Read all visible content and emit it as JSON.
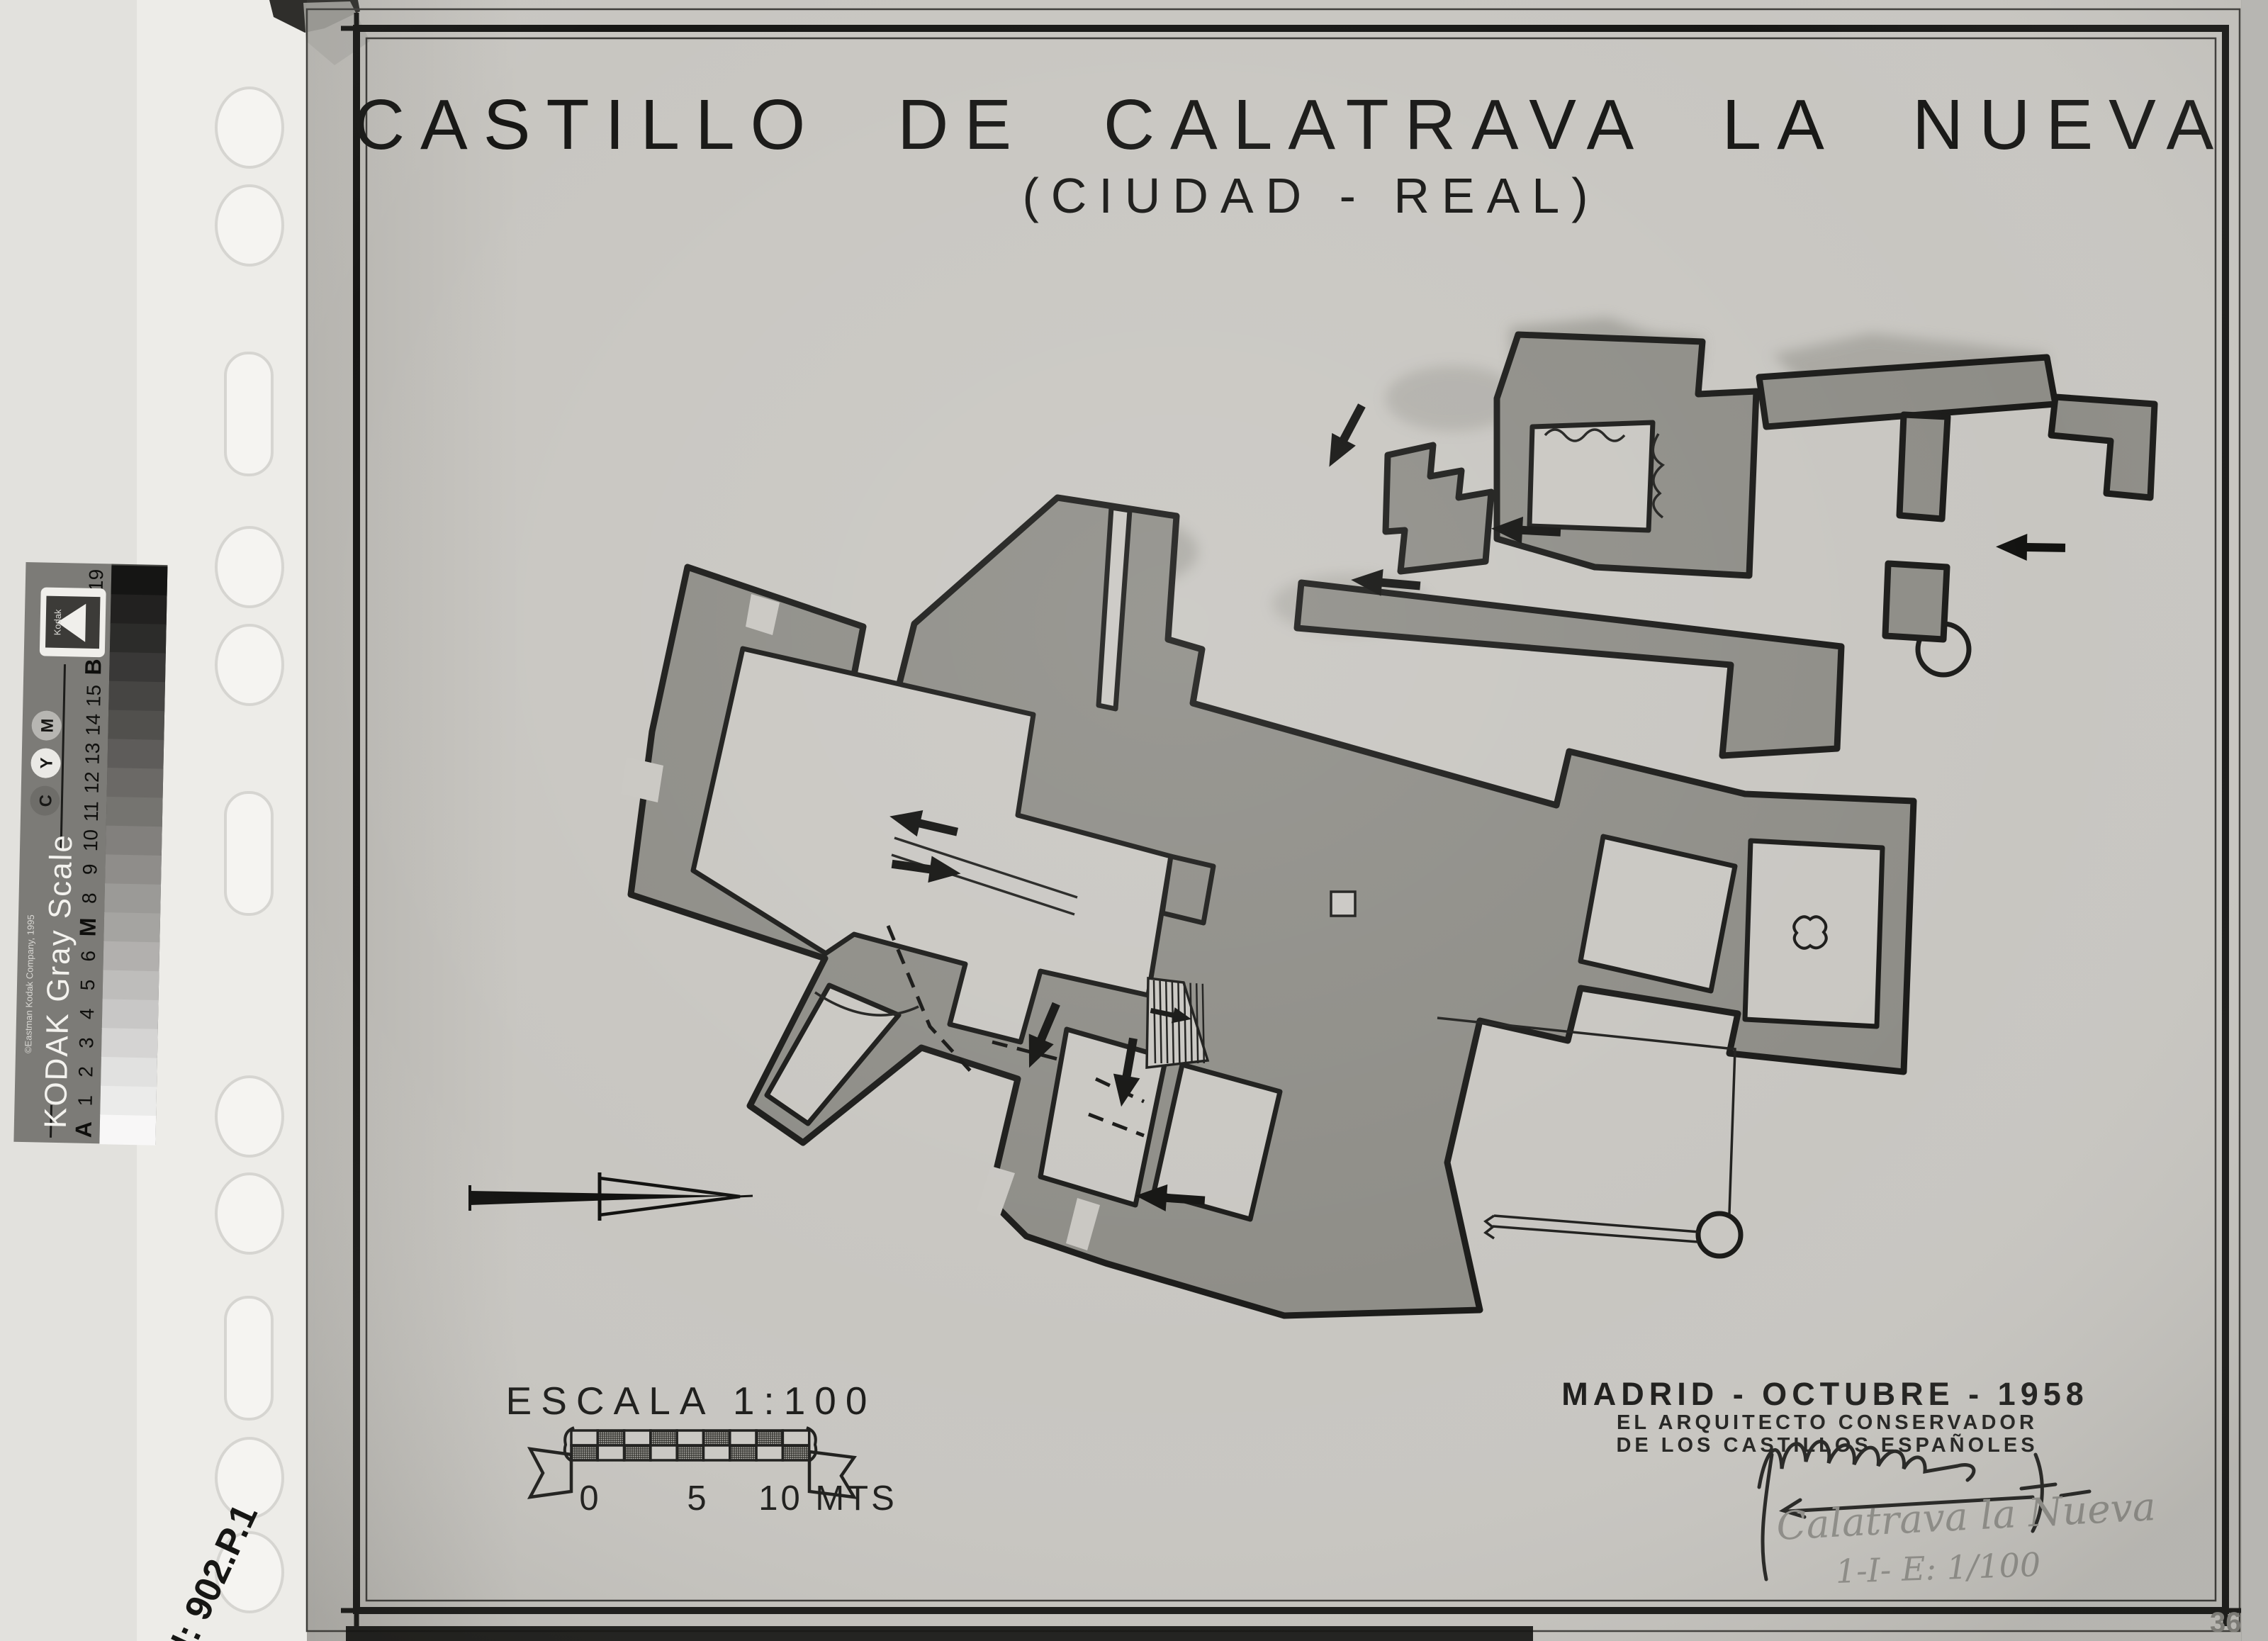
{
  "plan": {
    "title": "CASTILLO DE CALATRAVA LA NUEVA",
    "subtitle": "(CIUDAD - REAL)",
    "sheet_number": "36",
    "scale": {
      "label": "ESCALA 1:100",
      "tick0": "0",
      "tick5": "5",
      "tick10": "10 MTS"
    },
    "credits": {
      "line1": "MADRID - OCTUBRE - 1958",
      "line2": "EL ARQUITECTO CONSERVADOR",
      "line3": "DE LOS CASTILLOS ESPAÑOLES",
      "note_title": "Calatrava la Nueva",
      "note_ref": "1-I- E: 1/100"
    }
  },
  "annotations": {
    "archive_number": "N: 902.P.1"
  },
  "gray_scale": {
    "brand": "KODAK Gray Scale",
    "copyright": "©Eastman Kodak Company, 1995",
    "logo": "Kodak",
    "labels": [
      "19",
      "18",
      "17",
      "B",
      "15",
      "14",
      "13",
      "12",
      "11",
      "10",
      "9",
      "8",
      "M",
      "6",
      "5",
      "4",
      "3",
      "2",
      "1",
      "A"
    ],
    "ink_circles": [
      "M",
      "Y",
      "C"
    ]
  },
  "colors": {
    "paper": "#c8c6c1",
    "wall_gray": "#8e8d87",
    "ink": "#1b1b19",
    "sleeve": "#edece8",
    "strip_body": "#7c7b77"
  }
}
